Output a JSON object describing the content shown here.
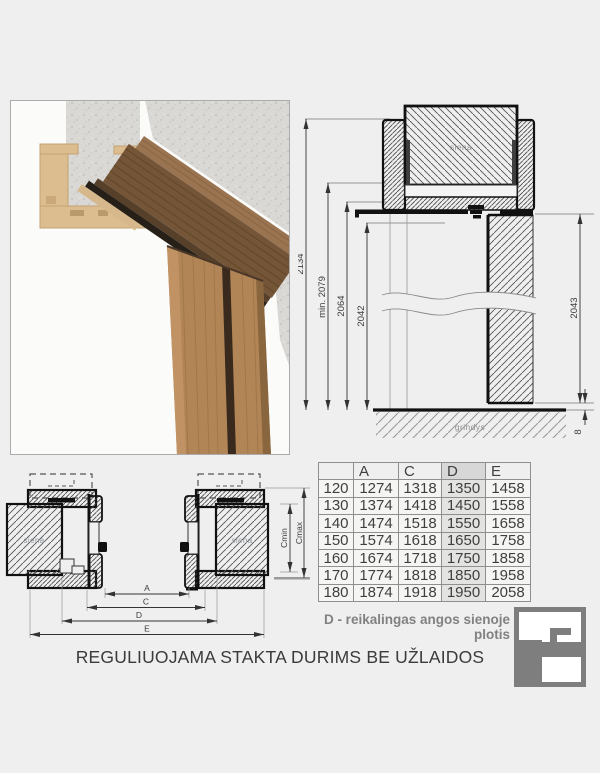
{
  "title": "REGULIUOJAMA STAKTA DURIMS BE UŽLAIDOS",
  "note": "D - reikalingas angos sienoje plotis",
  "vertical_section": {
    "wall_label": "siena",
    "floor_label": "grindys",
    "dims": {
      "total_height": "2134",
      "min_height": "min. 2079",
      "frame_height": "2064",
      "opening_height": "2042",
      "door_height": "2043",
      "floor_gap": "8"
    }
  },
  "horizontal_section": {
    "wall_label_left": "siena",
    "wall_label_right": "siena",
    "dims": {
      "a": "A",
      "c": "C",
      "d": "D",
      "e": "E",
      "cmin": "Cmin",
      "cmax": "Cmax"
    }
  },
  "table": {
    "headers": [
      "",
      "A",
      "C",
      "D",
      "E"
    ],
    "highlight_column": "D",
    "rows": [
      [
        "120",
        "1274",
        "1318",
        "1350",
        "1458"
      ],
      [
        "130",
        "1374",
        "1418",
        "1450",
        "1558"
      ],
      [
        "140",
        "1474",
        "1518",
        "1550",
        "1658"
      ],
      [
        "150",
        "1574",
        "1618",
        "1650",
        "1758"
      ],
      [
        "160",
        "1674",
        "1718",
        "1750",
        "1858"
      ],
      [
        "170",
        "1774",
        "1818",
        "1850",
        "1958"
      ],
      [
        "180",
        "1874",
        "1918",
        "1950",
        "2058"
      ]
    ]
  },
  "colors": {
    "background": "#efefef",
    "note_gray": "#818181",
    "table_highlight": "#e3e3e2",
    "logo_gray": "#7e7e7e"
  },
  "logo": {
    "name": "door-frame-logo"
  }
}
